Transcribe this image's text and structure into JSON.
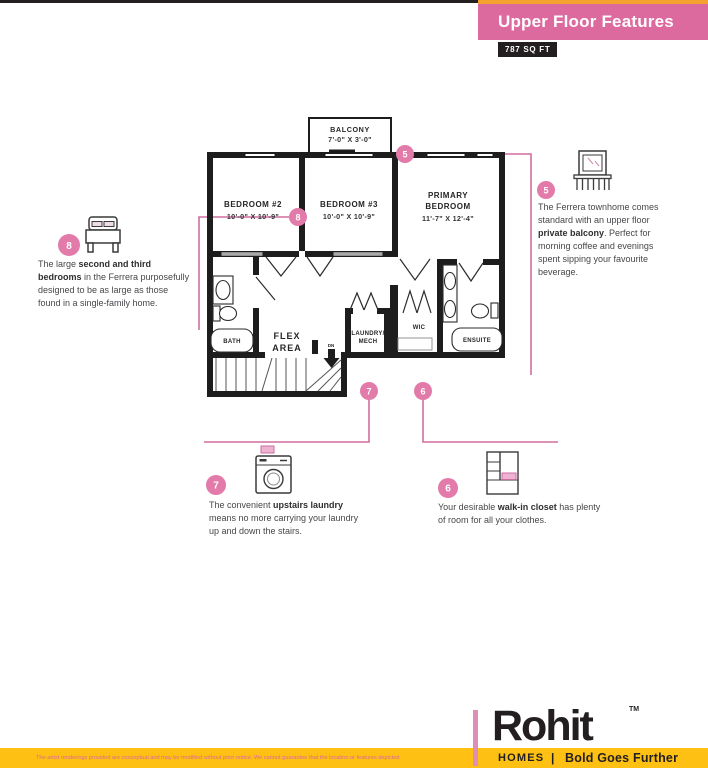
{
  "header": {
    "title": "Upper Floor Features",
    "sqft_badge": "787 SQ FT"
  },
  "plan": {
    "balcony": {
      "name": "BALCONY",
      "dims": "7'-0\" X 3'-0\""
    },
    "bedroom2": {
      "name": "BEDROOM #2",
      "dims": "10'-0\" X 10'-9\""
    },
    "bedroom3": {
      "name": "BEDROOM #3",
      "dims": "10'-0\" X 10'-9\""
    },
    "primary": {
      "name1": "PRIMARY",
      "name2": "BEDROOM",
      "dims": "11'-7\" X 12'-4\""
    },
    "flex1": "FLEX",
    "flex2": "AREA",
    "laundry1": "LAUNDRY/",
    "laundry2": "MECH",
    "wic": "WIC",
    "bath": "BATH",
    "ensuite": "ENSUITE",
    "dn": "DN"
  },
  "callouts": {
    "b8": {
      "num": "8",
      "pre": "The large ",
      "bold": "second and third bedrooms",
      "post": " in the Ferrera purposefully designed to be as large as those found in a single-family home."
    },
    "b5": {
      "num": "5",
      "pre": "The Ferrera townhome comes standard with an upper floor ",
      "bold": "private balcony",
      "post": ". Perfect for morning coffee and evenings spent sipping your favourite beverage."
    },
    "b7": {
      "num": "7",
      "pre": "The convenient ",
      "bold": "upstairs laundry",
      "post": " means no more carrying your laundry up and down the stairs."
    },
    "b6": {
      "num": "6",
      "pre": "Your desirable ",
      "bold": "walk-in closet",
      "post": " has plenty of room for all your clothes."
    }
  },
  "footer": {
    "disclaimer": "The artist renderings provided are conceptual and may be modified without prior notice. We cannot guarantee that the location or features depicted",
    "brand": "Rohit",
    "tm": "TM",
    "division": "HOMES",
    "divider": "|",
    "tagline": "Bold Goes Further"
  },
  "colors": {
    "banner_pink": "#dd6a9f",
    "stripe_orange": "#f5a12f",
    "circle_pink": "#e27ba9",
    "leader_pink": "#cf6f9d",
    "bar_yellow": "#fdc013",
    "badge_dark": "#231f20",
    "wall_black": "#1d1d1d"
  }
}
